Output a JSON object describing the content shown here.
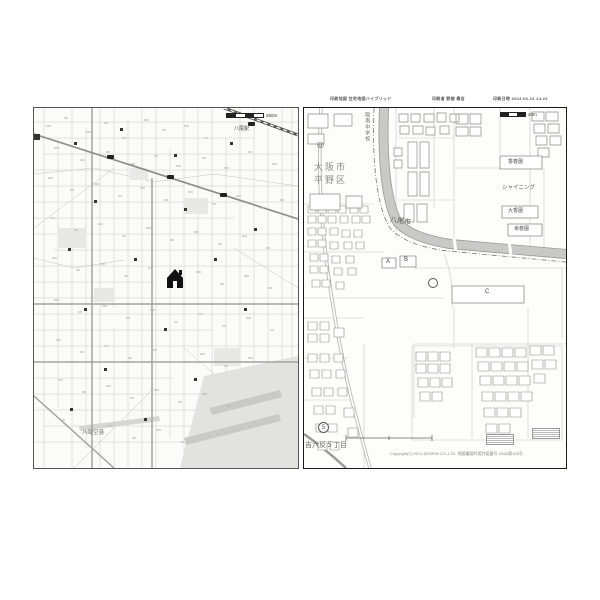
{
  "header": {
    "map_info": "印刷地図 住宅地図ハイブリッド",
    "printer_info": "印刷者 野間 春吉",
    "datetime_info": "印刷日時 2024.06.24 14:22"
  },
  "left_map": {
    "station_label": "八尾駅",
    "airport_label": "八尾空港",
    "scale_label": "250m"
  },
  "right_map": {
    "city_label": "大阪市",
    "ward_label": "平野区",
    "school_label": "阪南中学校",
    "boundary_city_label": "八尾市",
    "double_circle": "◎",
    "shining_label": "シャイニング",
    "garden_top_label": "香春園",
    "garden_mid_label": "大香園",
    "garden_bottom_label": "幸春園",
    "bldg_a": "A",
    "bldg_b": "B",
    "bldg_c": "C",
    "circle_number": "5",
    "district_label": "吉六反５丁目",
    "scale_label": "20m",
    "copyright": "Copyright(C) 2013 ZENRIN CO.,LTD.  地図複製利用許諾番号 Z06A第155号"
  },
  "colors": {
    "river": "#c9c9c6",
    "minor_street": "#c9c9c5",
    "major_road": "#a3a39f",
    "marker": "#111111"
  }
}
